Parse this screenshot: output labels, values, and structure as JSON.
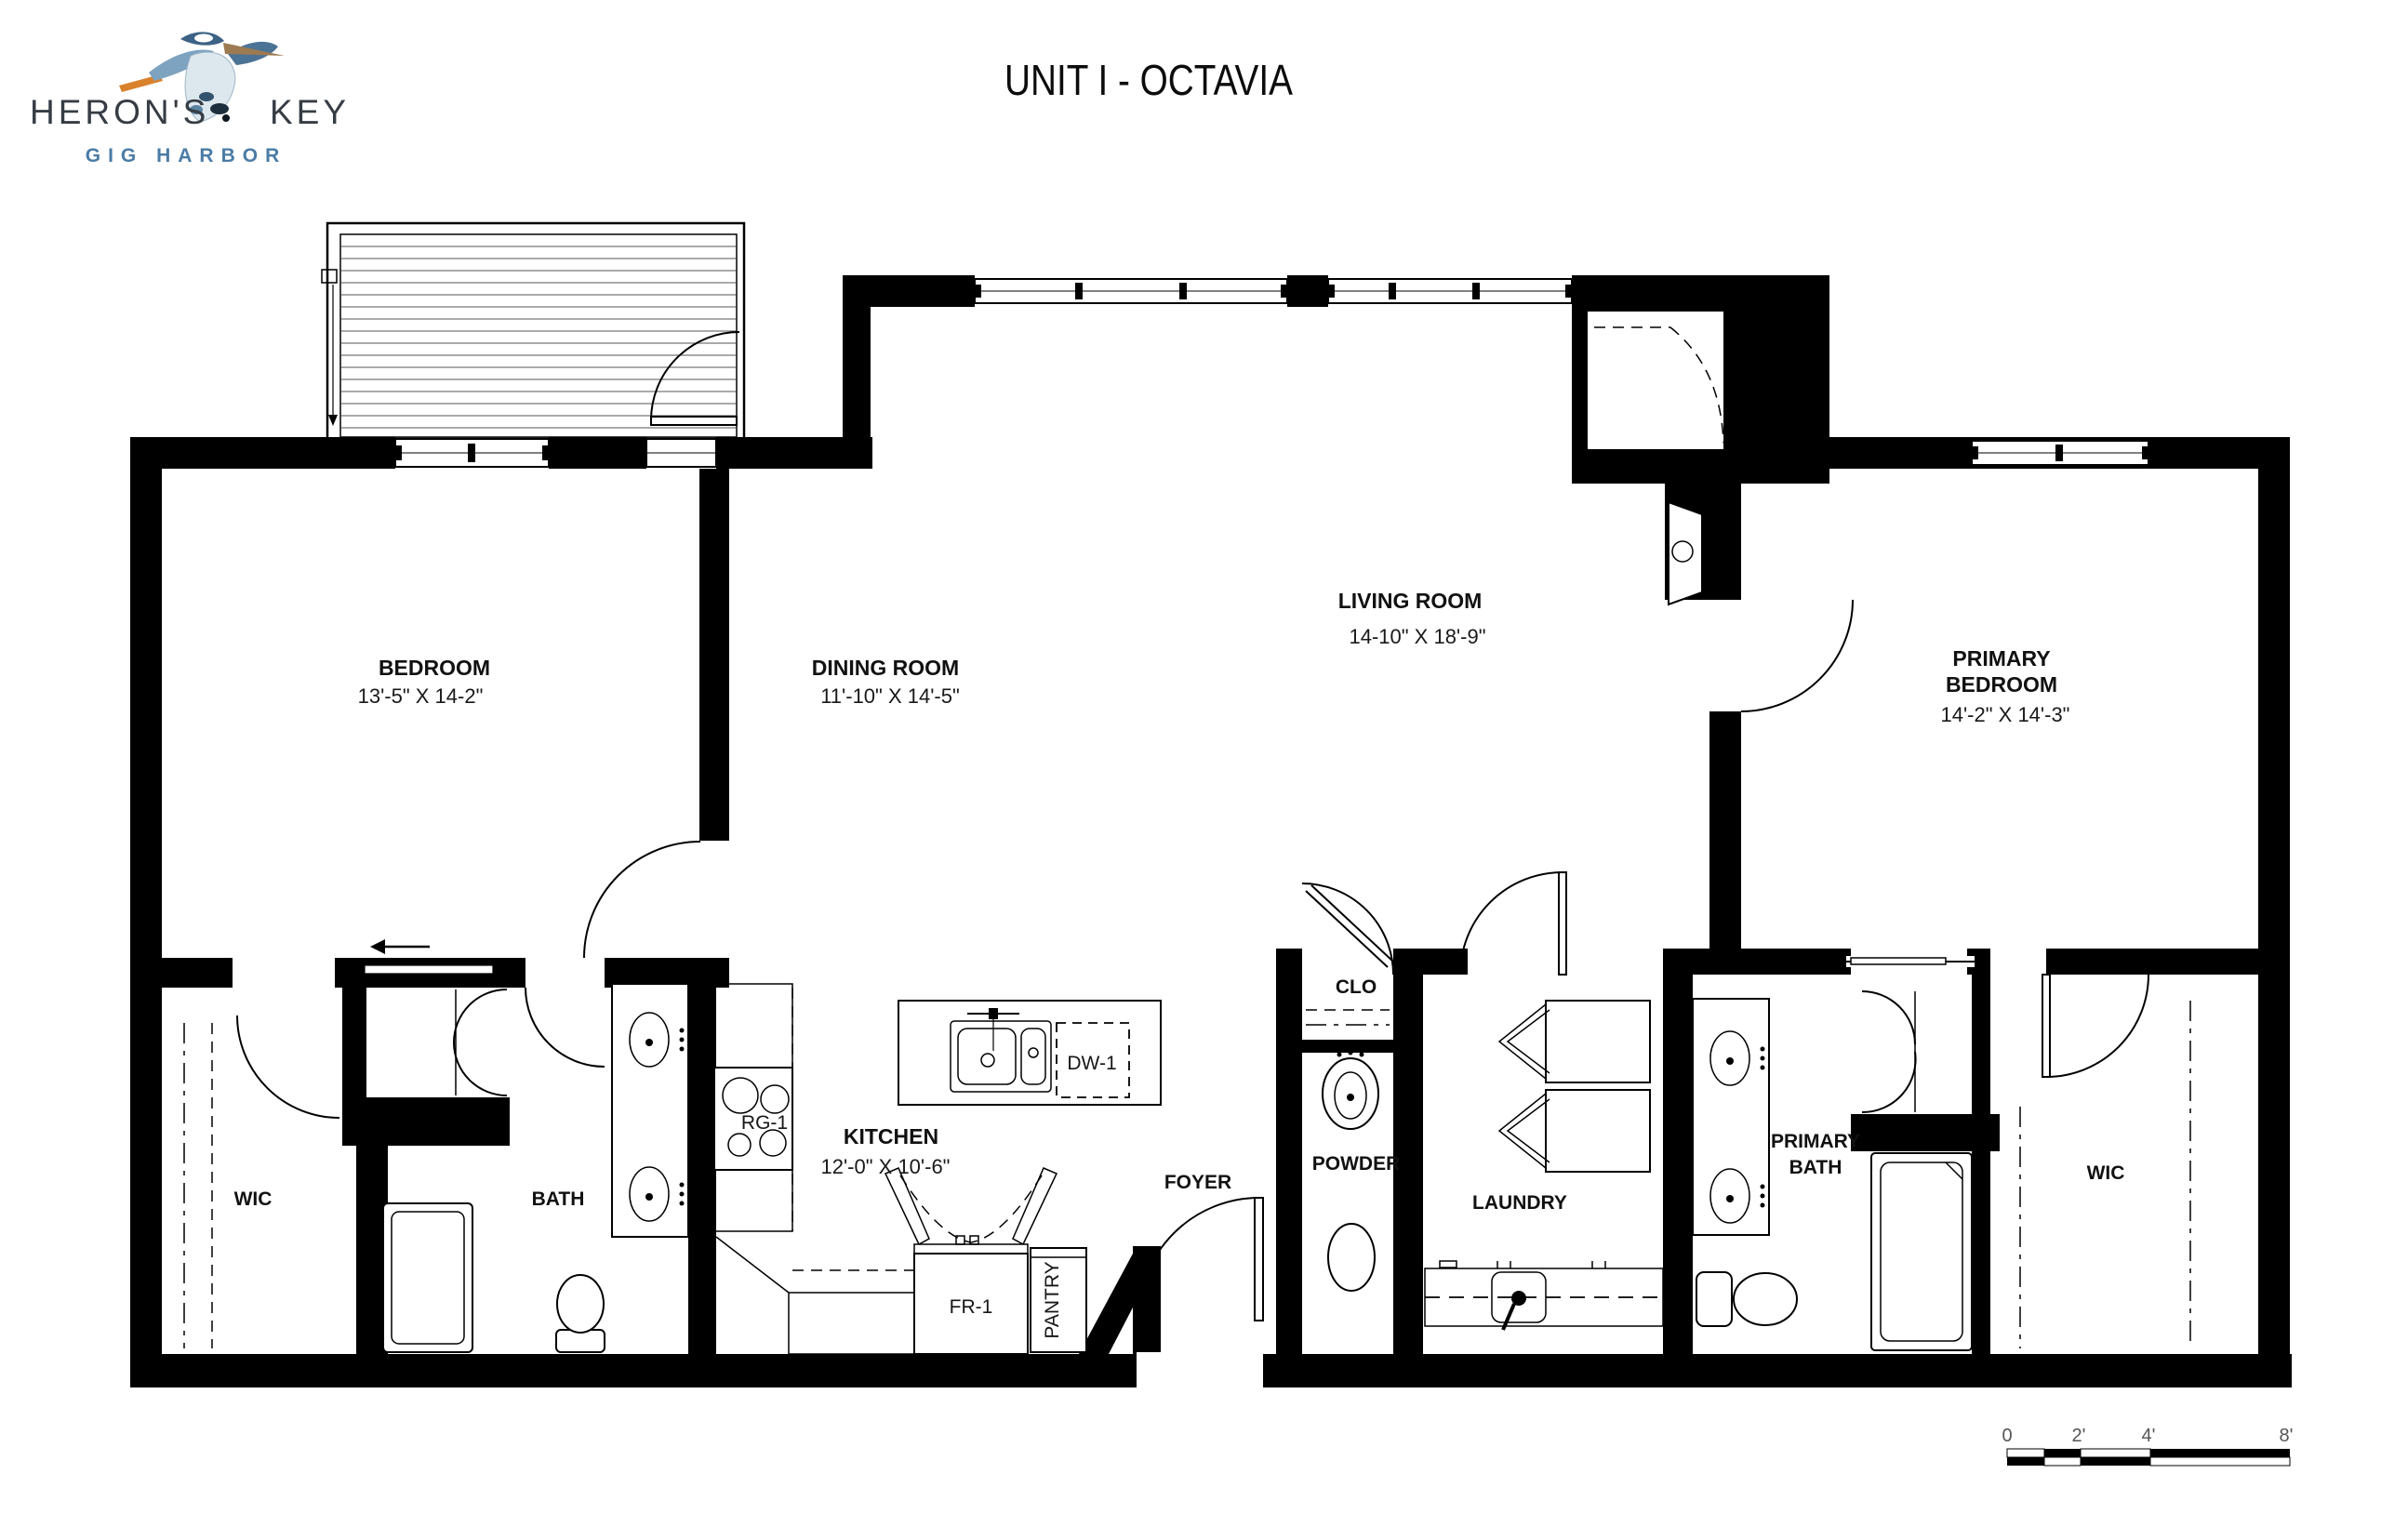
{
  "logo": {
    "brand_left": "HERON'S",
    "brand_right": "KEY",
    "subtitle": "GIG HARBOR",
    "icon": "heron-icon"
  },
  "title": "UNIT I - OCTAVIA",
  "plan": {
    "bedroom": {
      "name": "BEDROOM",
      "dims": "13'-5\" X 14-2\""
    },
    "dining": {
      "name": "DINING ROOM",
      "dims": "11'-10\" X 14'-5\""
    },
    "living": {
      "name": "LIVING ROOM",
      "dims": "14-10\" X 18'-9\""
    },
    "primary_bedroom": {
      "name1": "PRIMARY",
      "name2": "BEDROOM",
      "dims": "14'-2\" X 14'-3\""
    },
    "kitchen": {
      "name": "KITCHEN",
      "dims": "12'-0\" X 10'-6\""
    },
    "wic_left": {
      "name": "WIC"
    },
    "bath": {
      "name": "BATH"
    },
    "foyer": {
      "name": "FOYER"
    },
    "powder": {
      "name": "POWDER"
    },
    "clo": {
      "name": "CLO"
    },
    "laundry": {
      "name": "LAUNDRY"
    },
    "primary_bath": {
      "name1": "PRIMARY",
      "name2": "BATH"
    },
    "wic_right": {
      "name": "WIC"
    },
    "appliances": {
      "range": "RG-1",
      "dishwasher": "DW-1",
      "refrigerator": "FR-1",
      "pantry": "PANTRY"
    }
  },
  "scale_bar": {
    "t0": "0",
    "t1": "2'",
    "t2": "4'",
    "t3": "8'"
  },
  "colors": {
    "wall": "#000000",
    "logo_text": "#363c44",
    "logo_accent": "#4a7ca6",
    "heron_light": "#dde7ee",
    "heron_mid": "#7da3c0",
    "heron_dark": "#4b7396",
    "beak_orange": "#d9822b"
  }
}
